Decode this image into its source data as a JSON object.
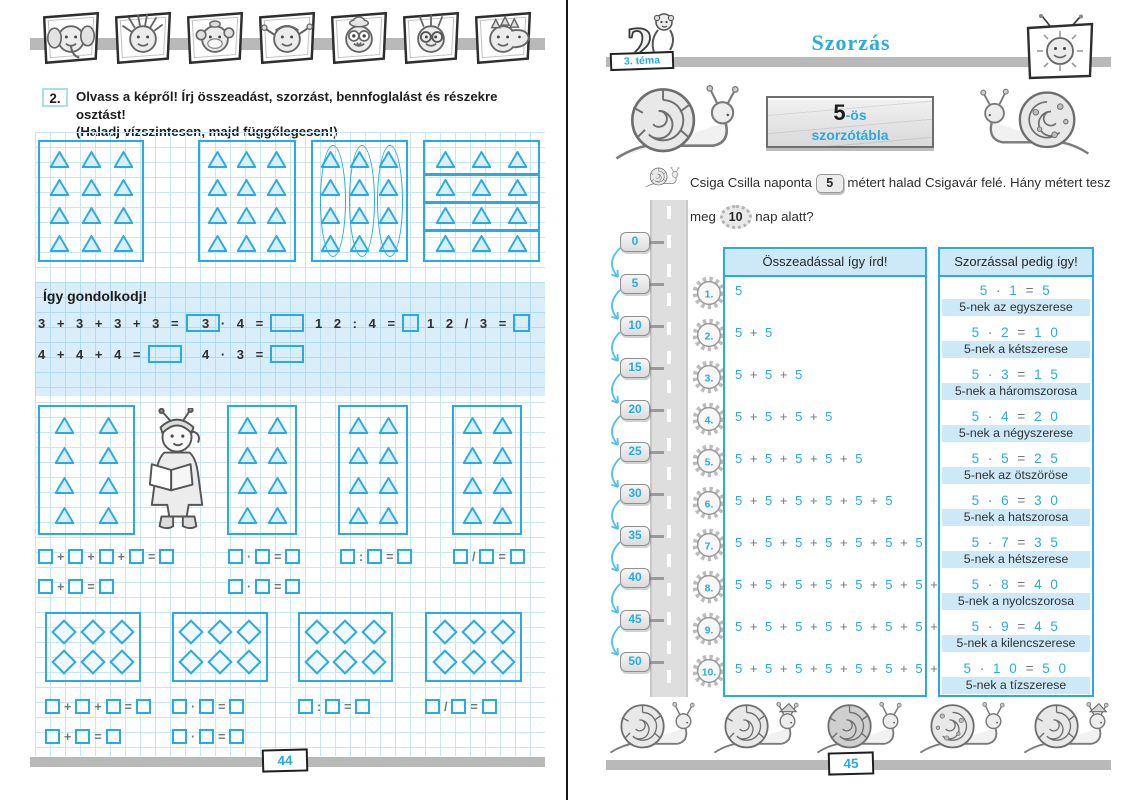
{
  "colors": {
    "accent": "#29abe2",
    "grid_line": "#c7e7f6",
    "band_tint": "#cde9f7",
    "bar_gray": "#b9b9b9",
    "text": "#2e2e2e"
  },
  "left_page": {
    "exercise_number": "2.",
    "instruction": "Olvass a képről! Írj összeadást, szorzást, bennfoglalást és részekre osztást!",
    "instruction2": "(Haladj vízszintesen, majd függőlegesen!)",
    "header_stamps": [
      "elephant",
      "spiky-boy",
      "monkey",
      "girl",
      "owl",
      "kid-glasses",
      "dino"
    ],
    "pictures": {
      "top_boxes": {
        "rows": 4,
        "cols": 3,
        "shape": "triangle",
        "variants": [
          "plain",
          "plain",
          "column-ovals",
          "row-lines"
        ]
      },
      "mid_boxes": {
        "rows": 4,
        "cols": 2,
        "shape": "triangle",
        "count": 4
      },
      "diamond_boxes": {
        "rows": 2,
        "cols": 3,
        "shape": "diamond",
        "count": 4
      }
    },
    "think": {
      "title": "Így gondolkodj!",
      "row1": [
        {
          "expr": "3 + 3 + 3 + 3 =",
          "box": "wide"
        },
        {
          "expr": "3 · 4 =",
          "box": "wide"
        },
        {
          "expr": "1 2 : 4 =",
          "box": "small"
        },
        {
          "expr": "1 2 / 3 =",
          "box": "small"
        }
      ],
      "row2": [
        {
          "expr": "4 + 4 + 4 =",
          "box": "wide"
        },
        {
          "expr": "4 · 3 =",
          "box": "wide"
        }
      ]
    },
    "equations_mid": {
      "row1": [
        [
          "+",
          "+",
          "+",
          "="
        ],
        [
          "·",
          "="
        ],
        [
          ":",
          "="
        ],
        [
          "/",
          "="
        ]
      ],
      "row2": [
        [
          "+",
          "="
        ],
        [
          "·",
          "="
        ]
      ]
    },
    "equations_bottom": {
      "row1": [
        [
          "+",
          "+",
          "="
        ],
        [
          "·",
          "="
        ],
        [
          ":",
          "="
        ],
        [
          "/",
          "="
        ]
      ],
      "row2": [
        [
          "+",
          "="
        ],
        [
          "·",
          "="
        ]
      ]
    },
    "page_number": "44"
  },
  "right_page": {
    "theme_label": "3. téma",
    "theme_number": "2",
    "title": "Szorzás",
    "sign": {
      "big": "5",
      "suffix": "-ös",
      "word": "szorzótábla"
    },
    "problem": {
      "p1": "Csiga Csilla naponta",
      "v1": "5",
      "p2": "métert halad Csigavár felé. Hány métert tesz",
      "p3": "meg",
      "v2": "10",
      "p4": "nap alatt?"
    },
    "milestones": [
      "0",
      "5",
      "10",
      "15",
      "20",
      "25",
      "30",
      "35",
      "40",
      "45",
      "50"
    ],
    "table": {
      "addition_header": "Összeadással így írd!",
      "multiplication_header": "Szorzással pedig így!",
      "rows": [
        {
          "num": "1.",
          "sum": "5",
          "product": "5 · 1 = 5",
          "label": "5-nek az egyszerese"
        },
        {
          "num": "2.",
          "sum": "5 + 5",
          "product": "5 · 2 = 1 0",
          "label": "5-nek a kétszerese"
        },
        {
          "num": "3.",
          "sum": "5 + 5 + 5",
          "product": "5 · 3 = 1 5",
          "label": "5-nek a háromszorosa"
        },
        {
          "num": "4.",
          "sum": "5 + 5 + 5 + 5",
          "product": "5 · 4 = 2 0",
          "label": "5-nek a négyszerese"
        },
        {
          "num": "5.",
          "sum": "5 + 5 + 5 + 5 + 5",
          "product": "5 · 5 = 2 5",
          "label": "5-nek az ötszöröse"
        },
        {
          "num": "6.",
          "sum": "5 + 5 + 5 + 5 + 5 + 5",
          "product": "5 · 6 = 3 0",
          "label": "5-nek a hatszorosa"
        },
        {
          "num": "7.",
          "sum": "5 + 5 + 5 + 5 + 5 + 5 + 5",
          "product": "5 · 7 = 3 5",
          "label": "5-nek a hétszerese"
        },
        {
          "num": "8.",
          "sum": "5 + 5 + 5 + 5 + 5 + 5 + 5 + 5",
          "product": "5 · 8 = 4 0",
          "label": "5-nek a nyolcszorosa"
        },
        {
          "num": "9.",
          "sum": "5 + 5 + 5 + 5 + 5 + 5 + 5 + 5 + 5",
          "product": "5 · 9 = 4 5",
          "label": "5-nek a kilencszerese"
        },
        {
          "num": "10.",
          "sum": "5 + 5 + 5 + 5 + 5 + 5 + 5 + 5 + 5 + 5",
          "product": "5 · 1 0 = 5 0",
          "label": "5-nek a tízszerese"
        }
      ]
    },
    "bottom_snails": [
      "snail-plain",
      "snail-bandana",
      "snail-dark",
      "snail-patch",
      "snail-cap"
    ],
    "page_number": "45"
  }
}
